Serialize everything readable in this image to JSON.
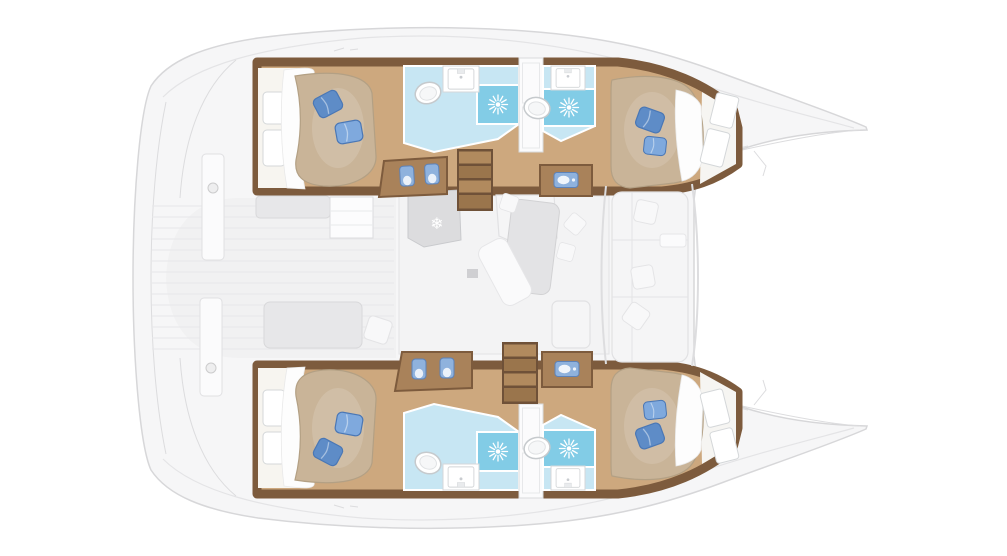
{
  "diagram": {
    "type": "yacht-floorplan",
    "vessel_type": "catamaran",
    "view": "top-down",
    "rooms": [
      "aft-cabin-port",
      "aft-head-port",
      "forward-head-port",
      "forward-cabin-port",
      "aft-cabin-starboard",
      "aft-head-starboard",
      "forward-head-starboard",
      "forward-cabin-starboard",
      "saloon",
      "galley",
      "aft-cockpit",
      "forward-cockpit"
    ],
    "counts": {
      "double_berths": 4,
      "bathrooms": 4,
      "showers": 4,
      "toilets": 4,
      "sinks": 4,
      "companionway_stairs": 2,
      "blue_pillows": 6,
      "white_pillows": 7
    }
  },
  "icons": {
    "snowflake": "❄"
  },
  "colors": {
    "hull_fill": "#f6f6f7",
    "hull_stroke": "#d7d7d9",
    "deck_line": "#e4e4e6",
    "deck_floor": "#f1f1f2",
    "deck_stripe": "#e7e7e9",
    "saloon_floor": "#f3f3f4",
    "wood": "#cda87e",
    "wood_mid": "#a9825a",
    "wood_dark": "#7d5b3d",
    "mattress": "#c9b498",
    "mattress_edge": "#b3a084",
    "sheet": "#fdfdfd",
    "pillow_blue": "#7fa9dd",
    "pillow_blue_dark": "#5e8cc7",
    "pillow_blue_stroke": "#4a77b5",
    "tile": "#c7e6f3",
    "shower": "#82cce6",
    "furniture": "#f5f5f6",
    "furniture_stroke": "#e1e1e3",
    "bench": "#e7e7e9",
    "table": "#e3e3e5",
    "counter_gray": "#dcdcde",
    "stair_light": "#b18a5e",
    "stair_dark": "#9a754c",
    "blue_item": "#8fb2dd",
    "blue_item_stroke": "#5d82b8"
  }
}
